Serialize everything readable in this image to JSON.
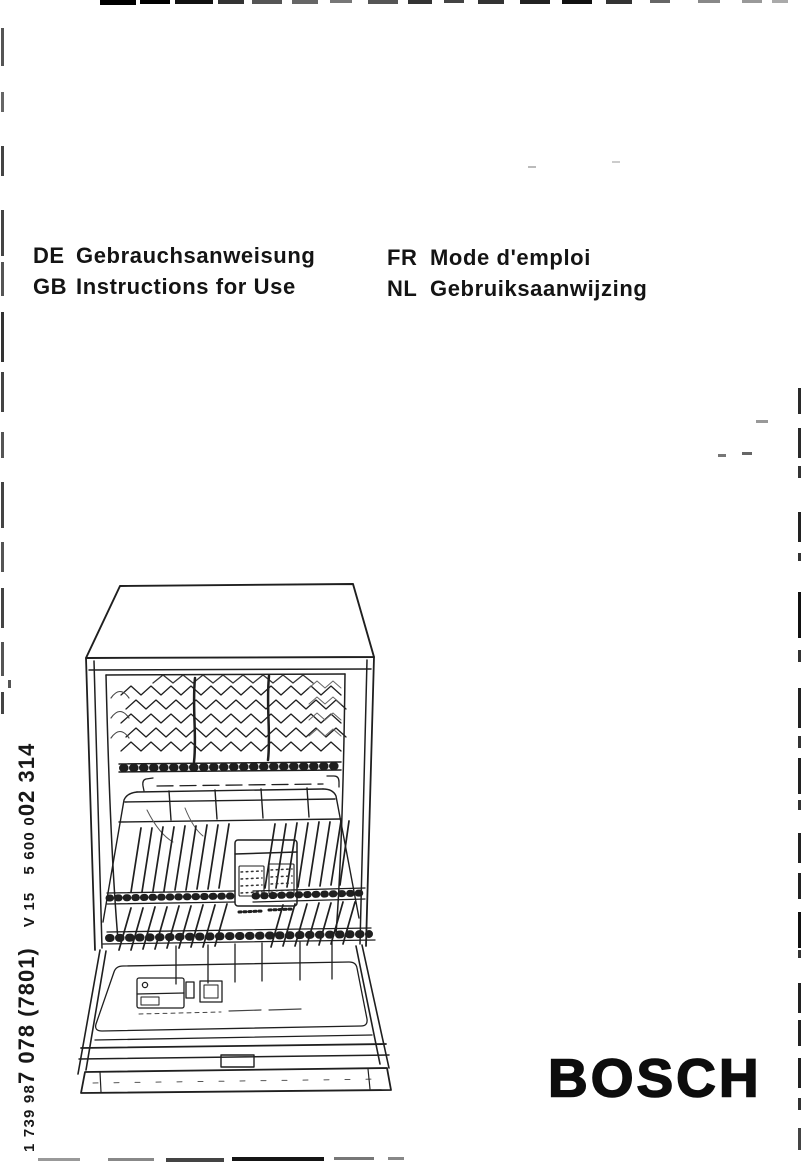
{
  "document": {
    "languages_left": [
      {
        "code": "DE",
        "title": "Gebrauchsanweisung"
      },
      {
        "code": "GB",
        "title": "Instructions for Use"
      }
    ],
    "languages_right": [
      {
        "code": "FR",
        "title": "Mode d'emploi"
      },
      {
        "code": "NL",
        "title": "Gebruiksaanwijzing"
      }
    ],
    "spine": {
      "part_prefix": "1 739 98",
      "part_bold": "7 078 (7801)",
      "version": "V 15",
      "code_prefix": "5 600 0",
      "code_bold": "02 314"
    },
    "brand": {
      "name": "BOSCH"
    },
    "illustration": {
      "alt": "Line drawing of an open dishwasher showing the upper basket with plate racks, the lower basket with a cutlery basket, and the detergent dispenser on the open door"
    }
  },
  "colors": {
    "ink": "#141414",
    "paper": "#ffffff"
  }
}
